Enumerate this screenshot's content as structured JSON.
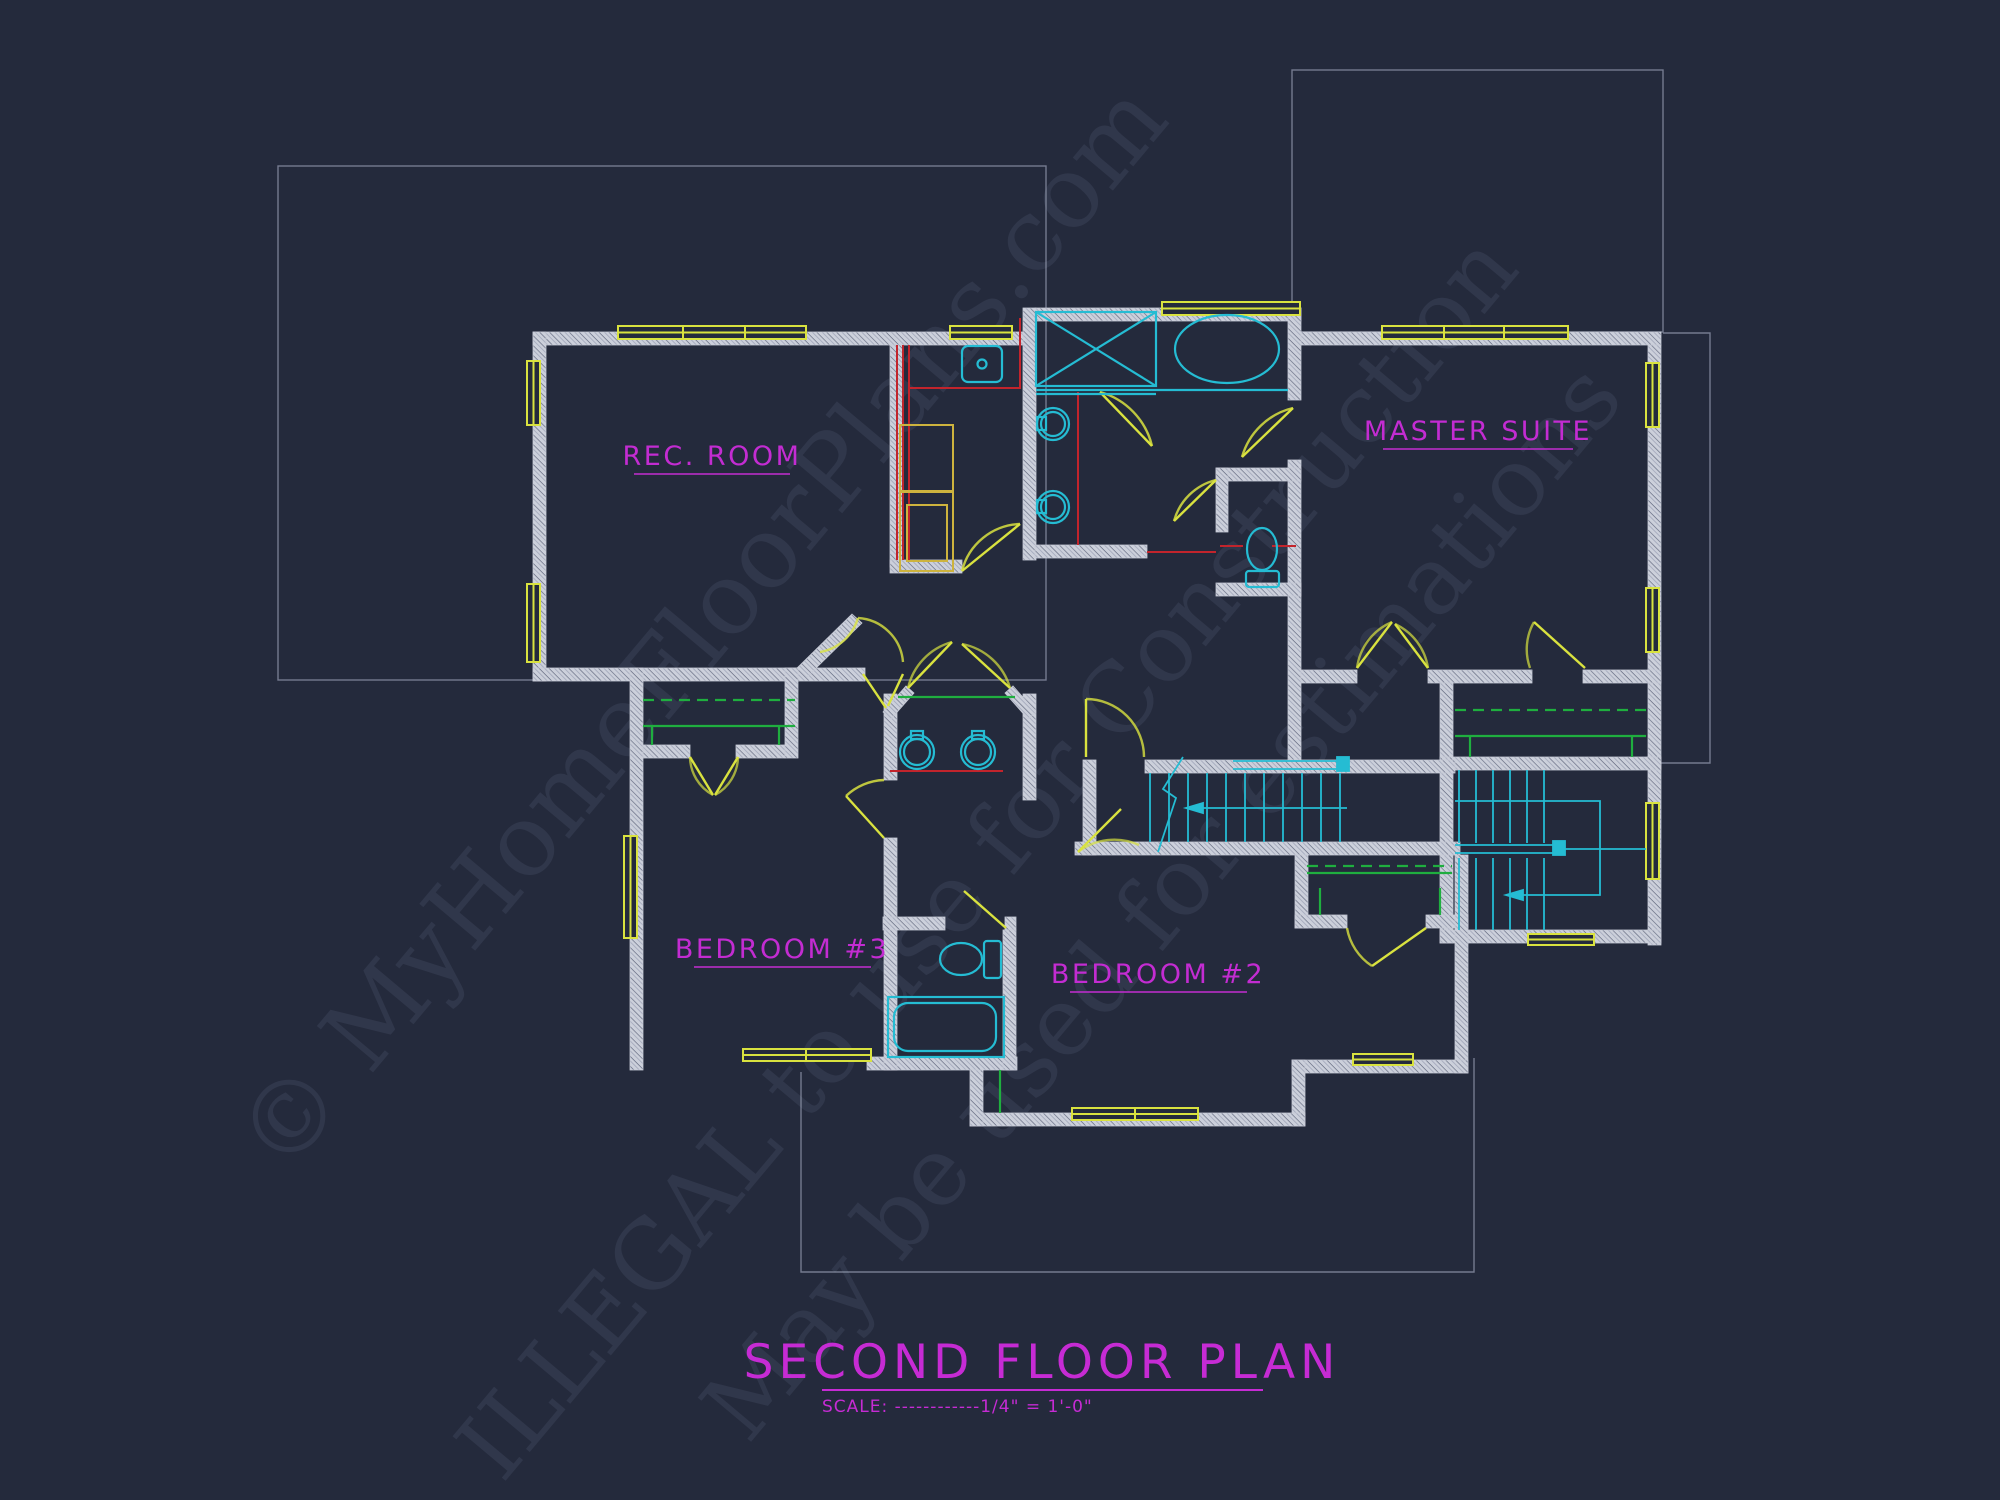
{
  "plan": {
    "rooms": [
      {
        "id": "rec_room",
        "label": "REC. ROOM"
      },
      {
        "id": "master_suite",
        "label": "MASTER SUITE"
      },
      {
        "id": "bedroom_3",
        "label": "BEDROOM #3"
      },
      {
        "id": "bedroom_2",
        "label": "BEDROOM #2"
      }
    ],
    "title": "SECOND FLOOR PLAN",
    "scale_note": "SCALE: ------------1/4\" = 1'-0\"",
    "watermark_lines": [
      "© MyHomeFloorPlans.com",
      "ILLEGAL to use for Construction",
      "May be used for estimations"
    ],
    "colors": {
      "background": "#242a3c",
      "walls": "#ccd0db",
      "wall_hatch": "#5f657c",
      "windows_and_doors": "#d9e23f",
      "fixtures": "#25bcd3",
      "closet_shelving": "#1fae3f",
      "counters": "#c2242c",
      "labels": "#c32cd2",
      "roof_outline": "#aab1c6",
      "watermark": "#8b96b8"
    }
  }
}
